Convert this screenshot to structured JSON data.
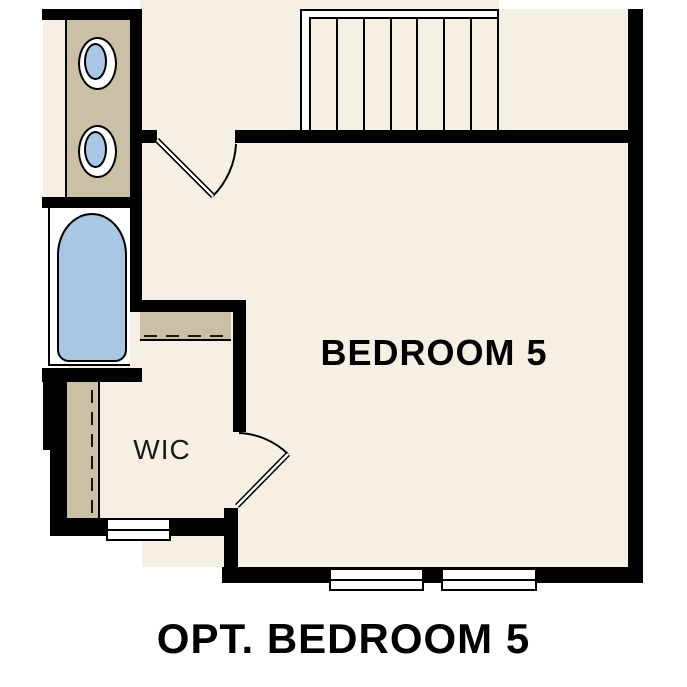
{
  "caption": "OPT. BEDROOM 5",
  "rooms": {
    "bedroom": {
      "label": "BEDROOM 5"
    },
    "wic": {
      "label": "WIC"
    }
  },
  "fixtures": {
    "stairs": {
      "tread_count": 7
    },
    "sink_count": 2,
    "bathtub_count": 1,
    "window_count": 3,
    "door_count": 2
  },
  "colors": {
    "background": "#ffffff",
    "floor": "#f6efe3",
    "wall": "#000000",
    "cabinet": "#cbbfa6",
    "fixture_blue": "#a9c7e4",
    "text": "#000000"
  }
}
